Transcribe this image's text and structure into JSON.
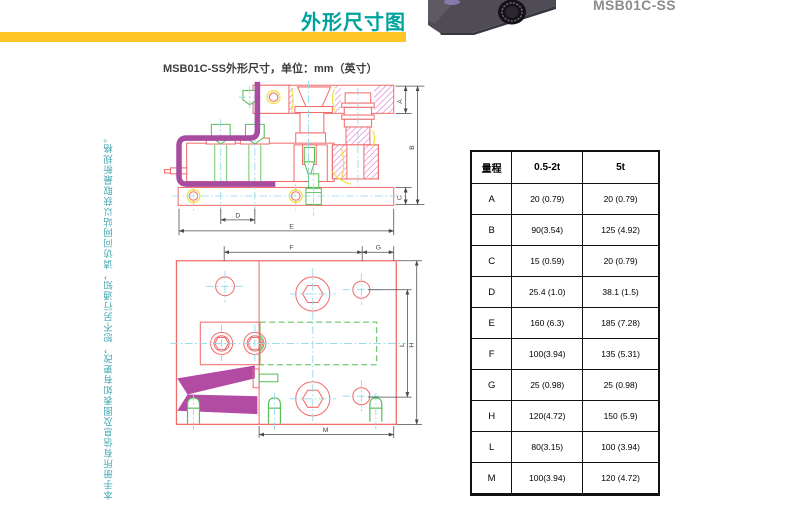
{
  "header": {
    "title": "外形尺寸图",
    "accent_color": "#00A39B",
    "bar_color": "#FFC425"
  },
  "product": {
    "name": "MSB01C-SS"
  },
  "side_note": "本手册所有信息及图表如有更改，恕不另行通知，请访问网站以获取最新规格。",
  "drawing": {
    "caption": "MSB01C-SS外形尺寸，单位：mm（英寸）",
    "line_colors": {
      "outline": "#F26B6B",
      "hatch": "#CC4FCC",
      "cable": "#A84CA0",
      "hardware": "#55BE55",
      "centerline": "#8FD8E8",
      "accent": "#EFE23B",
      "dimension": "#4A4A4A"
    },
    "dims": {
      "a": "A",
      "b": "B",
      "c": "C",
      "d": "D",
      "e": "E",
      "f": "F",
      "g": "G",
      "h": "H",
      "l": "L",
      "m": "M"
    }
  },
  "table": {
    "header": [
      "量程",
      "0.5-2t",
      "5t"
    ],
    "rows": [
      {
        "dim": "A",
        "v1": "20 (0.79)",
        "v2": "20 (0.79)"
      },
      {
        "dim": "B",
        "v1": "90(3.54)",
        "v2": "125 (4.92)"
      },
      {
        "dim": "C",
        "v1": "15 (0.59)",
        "v2": "20 (0.79)"
      },
      {
        "dim": "D",
        "v1": "25.4 (1.0)",
        "v2": "38.1 (1.5)"
      },
      {
        "dim": "E",
        "v1": "160 (6.3)",
        "v2": "185 (7.28)"
      },
      {
        "dim": "F",
        "v1": "100(3.94)",
        "v2": "135 (5.31)"
      },
      {
        "dim": "G",
        "v1": "25 (0.98)",
        "v2": "25 (0.98)"
      },
      {
        "dim": "H",
        "v1": "120(4.72)",
        "v2": "150 (5.9)"
      },
      {
        "dim": "L",
        "v1": "80(3.15)",
        "v2": "100 (3.94)"
      },
      {
        "dim": "M",
        "v1": "100(3.94)",
        "v2": "120 (4.72)"
      }
    ]
  }
}
